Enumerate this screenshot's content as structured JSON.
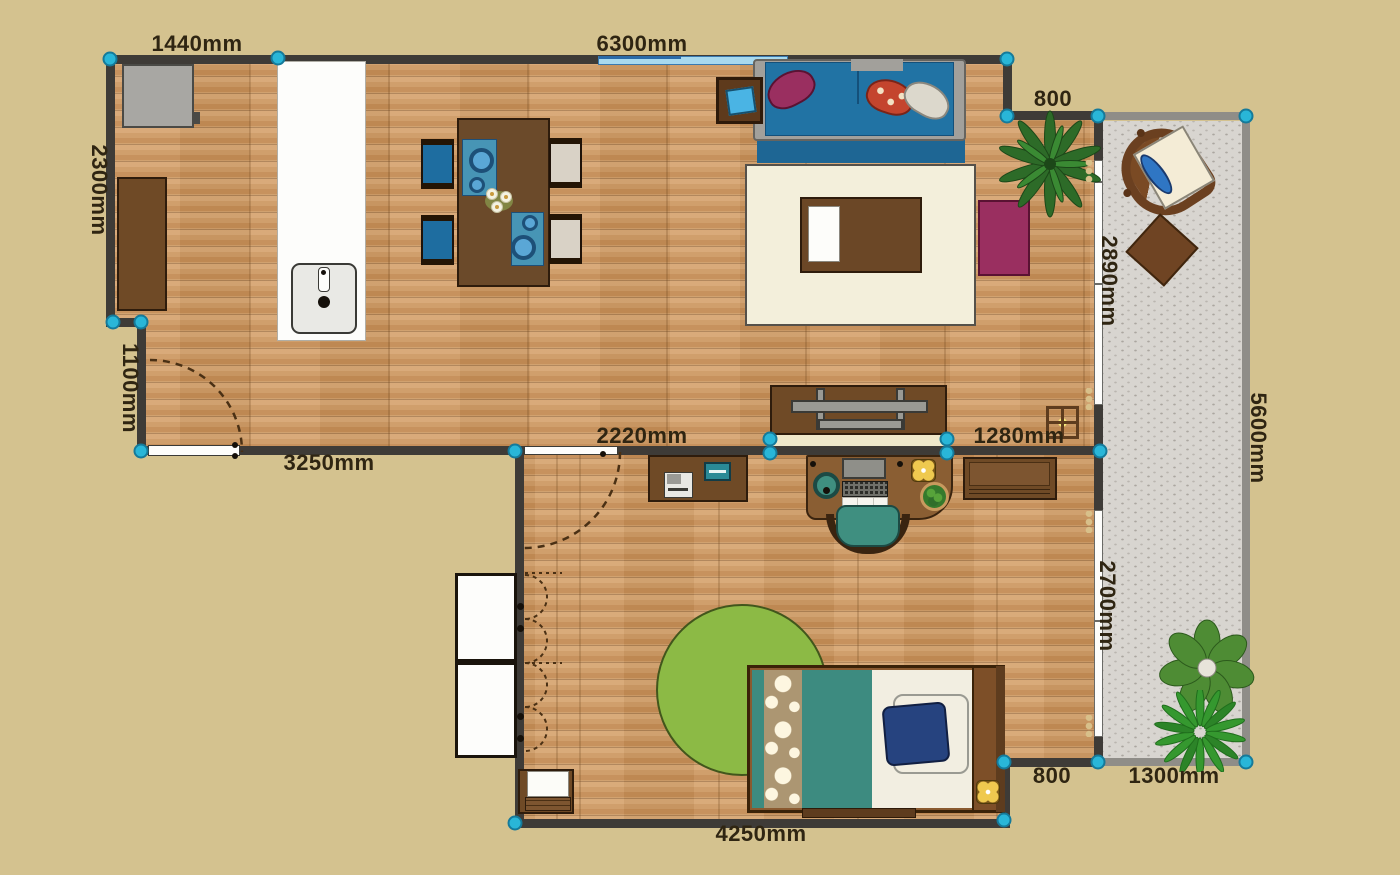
{
  "canvas": {
    "background": "#d4c28f",
    "wall_color": "#3e3b37",
    "marker_color": "#29b6d8",
    "balcony_wall_color": "#8f8d88"
  },
  "dimensions": [
    {
      "text": "1440mm"
    },
    {
      "text": "6300mm"
    },
    {
      "text": "800"
    },
    {
      "text": "2300mm"
    },
    {
      "text": "2890mm"
    },
    {
      "text": "5600mm"
    },
    {
      "text": "1100mm"
    },
    {
      "text": "3250mm"
    },
    {
      "text": "2220mm"
    },
    {
      "text": "1280mm"
    },
    {
      "text": "2700mm"
    },
    {
      "text": "800"
    },
    {
      "text": "1300mm"
    },
    {
      "text": "4250mm"
    }
  ],
  "rooms": [
    {
      "name": "living-dining-kitchen"
    },
    {
      "name": "bedroom-office"
    },
    {
      "name": "balcony"
    }
  ],
  "furniture_icons": [
    "stove-icon",
    "kitchen-cabinet-icon",
    "kitchen-counter-icon",
    "sink-icon",
    "dining-table-icon",
    "dining-chair-icon",
    "placemat-icon",
    "plate-icon",
    "flower-centerpiece-icon",
    "sofa-icon",
    "throw-pillow-icon",
    "side-table-icon",
    "tablet-icon",
    "area-rug-icon",
    "coffee-table-icon",
    "accent-mat-icon",
    "palm-plant-icon",
    "tv-stand-icon",
    "tv-icon",
    "sideboard-icon",
    "printer-icon",
    "laptop-icon",
    "desk-icon",
    "monitor-icon",
    "keyboard-icon",
    "speaker-icon",
    "desk-lamp-icon",
    "desk-plant-icon",
    "office-chair-icon",
    "wall-shelf-icon",
    "ceiling-lamp-icon",
    "round-rug-icon",
    "bed-icon",
    "pillow-icon",
    "nightstand-icon",
    "bedside-lamp-icon",
    "wardrobe-icon",
    "lounge-chair-icon",
    "patio-table-icon",
    "monstera-plant-icon",
    "bush-plant-icon",
    "door-icon",
    "door-swing-arc",
    "window-icon",
    "corner-handle"
  ]
}
